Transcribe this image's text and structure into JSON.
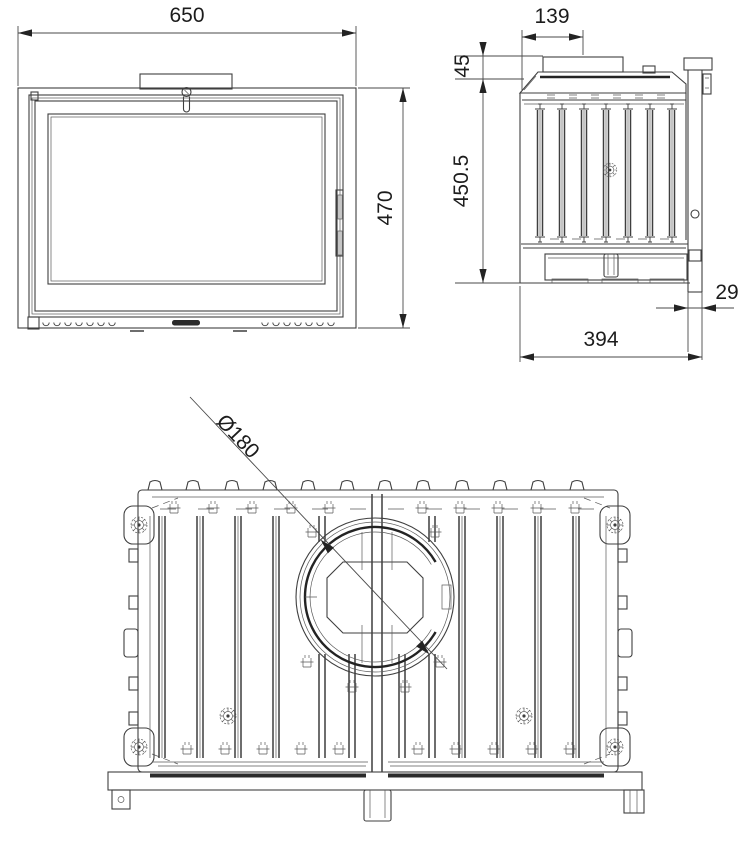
{
  "drawing": {
    "type": "technical-drawing",
    "views": {
      "front": {
        "name": "front view",
        "dims": {
          "width": "650",
          "height": "470"
        }
      },
      "side": {
        "name": "side view",
        "dims": {
          "flue_offset": "139",
          "top_section_height": "45",
          "body_height": "450.5",
          "door_overhang": "29",
          "depth": "394"
        }
      },
      "top": {
        "name": "top view",
        "dims": {
          "flue_diameter": "Ø180"
        }
      }
    },
    "colors": {
      "line": "#3f3f3f",
      "text": "#1c1c1c",
      "dark_fill": "#2b2b2b",
      "background": "#ffffff"
    }
  }
}
